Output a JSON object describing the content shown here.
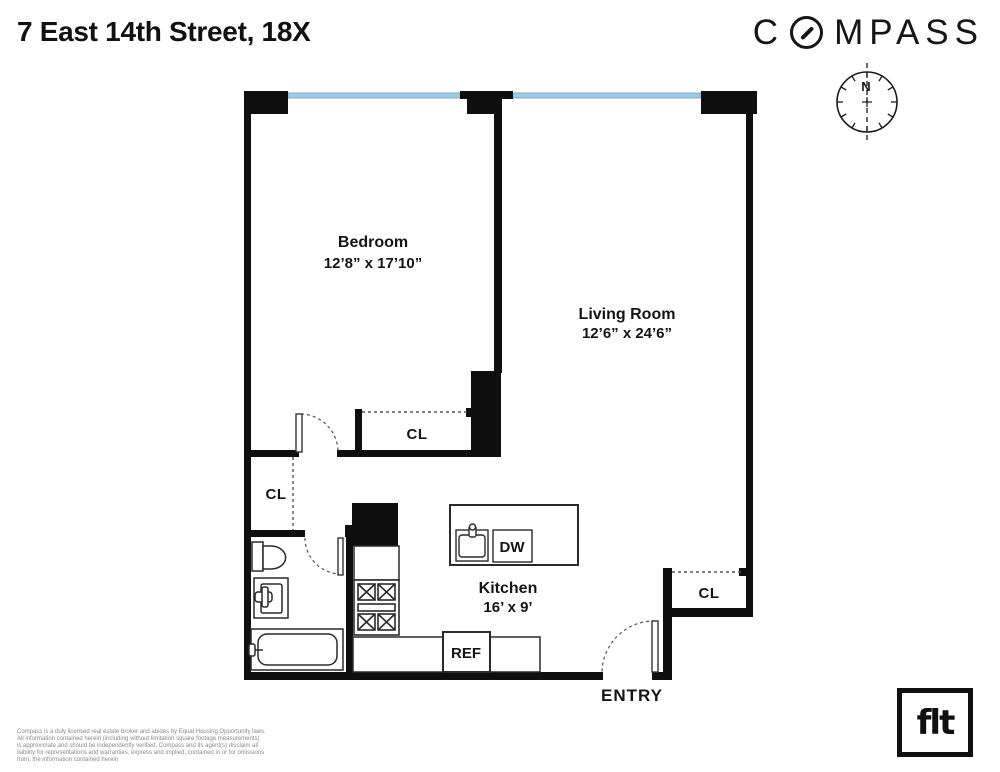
{
  "header": {
    "title": "7 East 14th Street, 18X",
    "brand": {
      "full": "COMPASS",
      "prefix": "C",
      "suffix": "MPASS"
    }
  },
  "compass_rose": {
    "north_label": "N"
  },
  "floorplan": {
    "rooms": {
      "bedroom": {
        "name": "Bedroom",
        "dimensions": "12’8” x 17’10”"
      },
      "living_room": {
        "name": "Living Room",
        "dimensions": "12’6” x 24’6”"
      },
      "kitchen": {
        "name": "Kitchen",
        "dimensions": "16’ x 9’"
      }
    },
    "labels": {
      "closet": "CL",
      "entry": "ENTRY",
      "refrigerator": "REF",
      "dishwasher": "DW"
    }
  },
  "footer": {
    "disclaimer_lines": [
      "Compass is a duly licensed real estate broker and abides by Equal Housing Opportunity laws.",
      "All information contained herein (including without limitation square footage measurements)",
      "is approximate and should be independently verified. Compass and its agent(s) disclaim all",
      "liability for representations and warranties, express and implied, contained in or for omissions",
      "from, the information contained herein"
    ],
    "flt_logo_text": "flt"
  },
  "colors": {
    "wall": "#0f0f0f",
    "window_glass": "#9dcbe4",
    "label_text": "#151515",
    "disclaimer_text": "#8a8a8a"
  }
}
